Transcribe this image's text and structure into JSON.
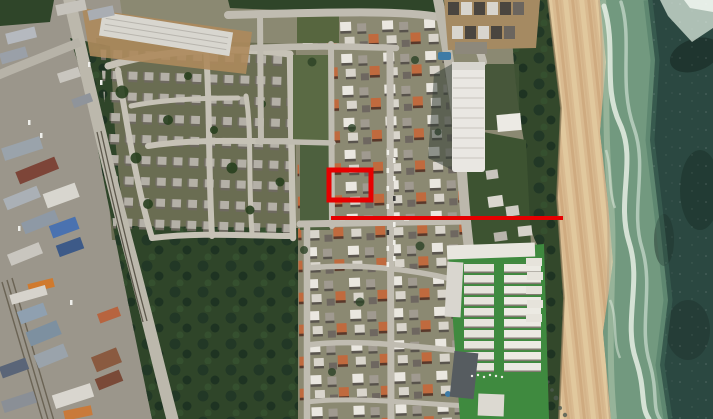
{
  "view": {
    "type": "satellite-aerial-imagery",
    "width_px": 713,
    "height_px": 419
  },
  "annotations": {
    "highlight_box": {
      "x": 329,
      "y": 170,
      "width": 42,
      "height": 30,
      "color": "#e60000",
      "stroke_width": 5
    },
    "reference_line": {
      "x1": 331,
      "y1": 218,
      "x2": 563,
      "y2": 218,
      "color": "#e60000",
      "stroke_width": 4
    }
  },
  "palette": {
    "ocean_deep": "#2b4841",
    "surf": "#72997f",
    "foam": "#e6efe4",
    "beach": "#d9ba90",
    "dune_vegetation": "#33482b",
    "field_vegetation": "#2f4529",
    "estate_ground": "#6a6d52",
    "residential_ground": "#8b8972",
    "road": "#bcb8ac",
    "lawn": "#3f8a3f",
    "warehouse_blue": "#4a72b0",
    "warehouse_orange": "#d07a2e",
    "warehouse_maroon": "#7d4538",
    "roof_white": "#e9e7e2",
    "roof_terracotta": "#c06a3e",
    "pool_blue": "#3e7ba6"
  }
}
